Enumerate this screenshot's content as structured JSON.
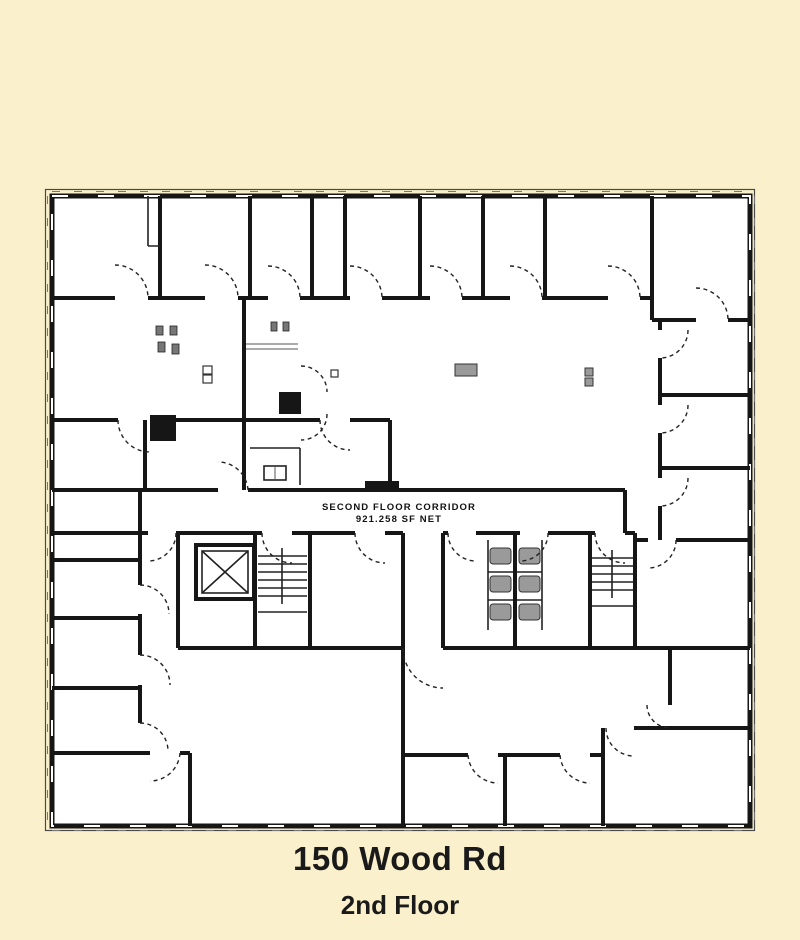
{
  "colors": {
    "page_bg": "#FAF0CB",
    "floor": "#FFFFFF",
    "wall": "#161616",
    "detail_gray": "#9a9a9a",
    "text": "#1a1a1a"
  },
  "plan": {
    "corridor_label_line1": "SECOND FLOOR CORRIDOR",
    "corridor_label_line2": "921.258 SF NET",
    "features": [
      "elevator-shaft",
      "stairway-west",
      "stairway-east",
      "restroom-west",
      "restroom-east",
      "perimeter-offices",
      "open-office-area",
      "corridor"
    ]
  },
  "caption": {
    "title": "150 Wood Rd",
    "subtitle": "2nd Floor"
  }
}
